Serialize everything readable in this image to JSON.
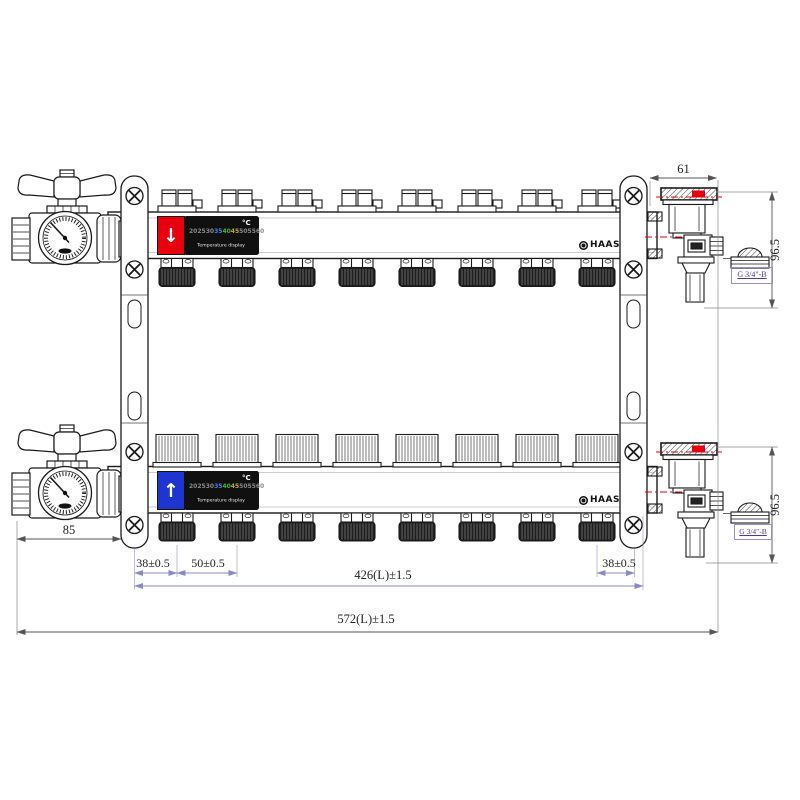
{
  "drawing": {
    "type": "manifold technical drawing",
    "description": "Stainless floor-heating manifold pair with temperature displays, ball valves, gauges, air vents and drain valves"
  },
  "brand": {
    "logo_text": "HAAS"
  },
  "display": {
    "unit": "°C",
    "caption": "Temperature display",
    "scale": [
      "20",
      "25",
      "30",
      "35",
      "40",
      "45",
      "50",
      "55",
      "60"
    ]
  },
  "flow": {
    "supply_arrow": "↓",
    "return_arrow": "↑"
  },
  "dimensions": {
    "top_width": "61",
    "side_height_top": "96.5",
    "side_height_bottom": "96.5",
    "thread_top": "G 3/4\"-B",
    "thread_bottom": "G 3/4\"-B",
    "valve_offset": "85",
    "first_outlet": "38±0.5",
    "outlet_pitch": "50±0.5",
    "last_outlet": "38±0.5",
    "manifold_length": "426(L)±1.5",
    "overall_length": "572(L)±1.5"
  },
  "colors": {
    "supply_red": "#e8000e",
    "return_blue": "#1f35cf",
    "display_bg": "#101010",
    "scale_gray": "#8a8a8a",
    "scale_blue": "#4d7fe8",
    "scale_green": "#3dbb3d",
    "scale_yellow": "#c8a832",
    "dim_purple": "#8a8ac8",
    "centerline_red": "#e8000e",
    "line": "#1a1a1a"
  }
}
